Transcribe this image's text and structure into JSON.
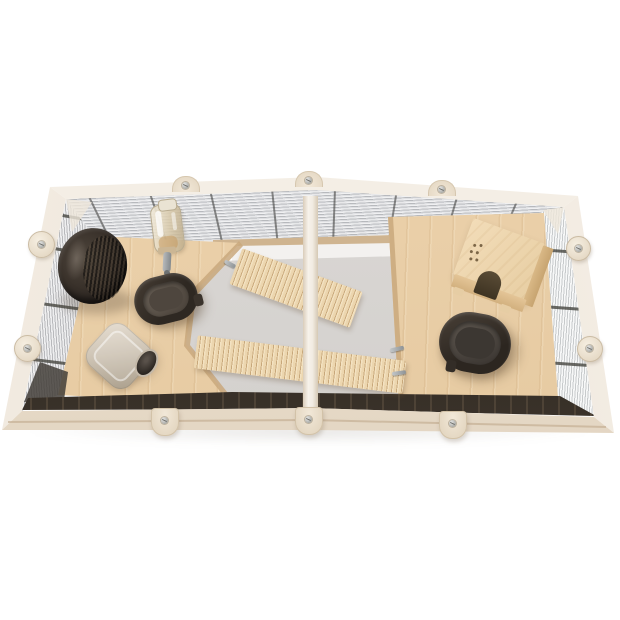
{
  "meta": {
    "alt": "Top view of an open wooden small-pet cage with two chambers, wire mesh walls, plywood platforms, two slatted ramps, an exercise wheel, a drinking bottle, two dark feeding bowls, a ceramic hideout and a wooden hideout house",
    "width": 620,
    "height": 620
  },
  "colors": {
    "bg": "#ffffff",
    "frame": "#eee6da",
    "frame_hi": "#f7f2ea",
    "mesh_back_hi": "#e8e9eb",
    "mesh_back_lo": "#cbccd0",
    "mesh_left_hi": "#f2f2f3",
    "mesh_left_lo": "#aeb0b4",
    "mesh_right_hi": "#f7f8f8",
    "mesh_right_lo": "#cfd4d5",
    "wire": "#4f4f4d",
    "batten_hi": "#d9c09c",
    "batten_lo": "#bfa27e",
    "wall_white": "#f3f1ef",
    "floor_hi": "#dedbd8",
    "floor_lo": "#cfccc9",
    "ply_hi": "#eed5b0",
    "ply_lo": "#e3c69c",
    "ply_edge": "#c9a87c",
    "beige": "#cfc5b6",
    "house_top": "#f2dcb8",
    "bottle_edge": "#b9ac90",
    "plastic_dark": "#2e2822",
    "plastic_inner": "#57504a",
    "metal": "#9b9ea0"
  },
  "objects": {
    "cage_frame": {
      "label": "Whitewashed wooden cage frame"
    },
    "divider": {
      "label": "Centre divider bar"
    },
    "back_mesh": {
      "label": "Wire mesh back wall"
    },
    "left_mesh": {
      "label": "Wire mesh left wall"
    },
    "right_mesh": {
      "label": "Wire mesh right wall"
    },
    "left_platform": {
      "label": "Left plywood platform"
    },
    "right_platform": {
      "label": "Right plywood platform"
    },
    "upper_ramp": {
      "label": "Slatted wooden ramp (upper)"
    },
    "lower_ramp": {
      "label": "Slatted wooden ramp (lower)"
    },
    "wheel": {
      "label": "Exercise wheel"
    },
    "water_bottle": {
      "label": "Drinking bottle"
    },
    "left_bowl": {
      "label": "Feeding bowl in left chamber"
    },
    "right_bowl": {
      "label": "Feeding bowl in right chamber"
    },
    "ceramic_hideout": {
      "label": "Ceramic hideout"
    },
    "wooden_hideout": {
      "label": "Wooden hideout house"
    }
  }
}
